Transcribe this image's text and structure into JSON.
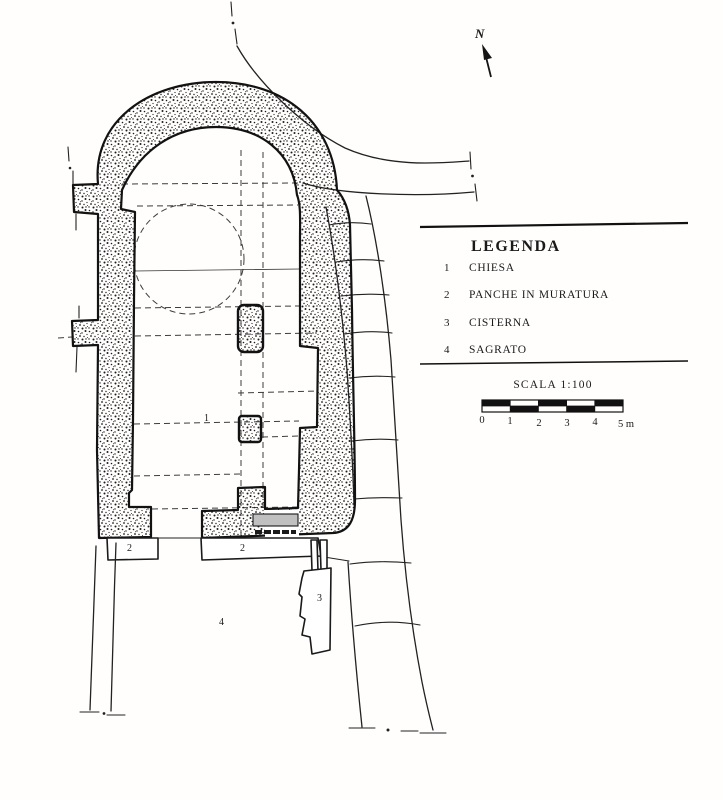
{
  "figure": {
    "kind": "archaeological site plan, scanned line drawing",
    "north": {
      "label": "N"
    },
    "legend": {
      "title": "LEGENDA",
      "items": [
        {
          "num": "1",
          "label": "CHIESA"
        },
        {
          "num": "2",
          "label": "PANCHE IN MURATURA"
        },
        {
          "num": "3",
          "label": "CISTERNA"
        },
        {
          "num": "4",
          "label": "SAGRATO"
        }
      ]
    },
    "scale": {
      "title": "SCALA 1:100",
      "ticks": [
        "0",
        "1",
        "2",
        "3",
        "4",
        "5 m"
      ]
    },
    "plan_labels": [
      {
        "text": "1"
      },
      {
        "text": "2"
      },
      {
        "text": "2"
      },
      {
        "text": "3"
      },
      {
        "text": "4"
      }
    ],
    "colors": {
      "ink": "#1a1a1a",
      "paper": "#ffffff",
      "step_gray": "#c0c0c0"
    }
  }
}
